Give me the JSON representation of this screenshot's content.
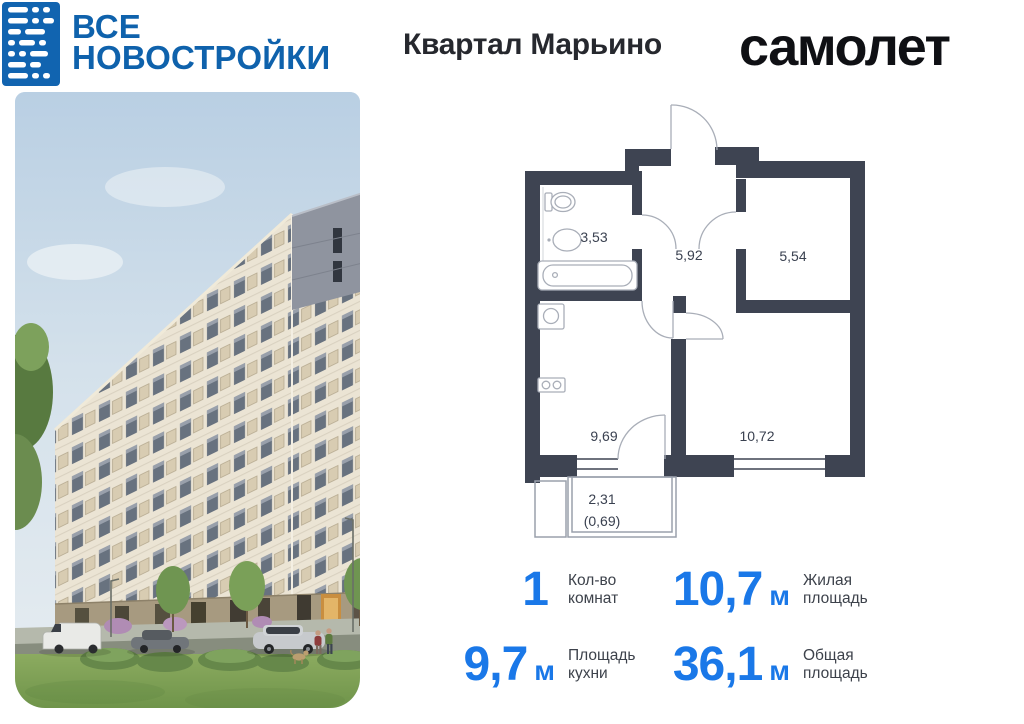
{
  "header": {
    "site_logo": {
      "line1": "ВСЕ",
      "line2": "НОВОСТРОЙКИ"
    },
    "title": "Квартал Марьино",
    "developer": "самолет"
  },
  "floor_plan": {
    "areas": {
      "bathroom": "3,53",
      "hallway": "5,92",
      "bedroom": "5,54",
      "kitchen": "9,69",
      "living_room": "10,72",
      "balcony": "2,31",
      "balcony_reduced": "(0,69)"
    }
  },
  "stats": [
    {
      "value": "1",
      "unit": "",
      "label1": "Кол-во",
      "label2": "комнат"
    },
    {
      "value": "10,7",
      "unit": "м",
      "label1": "Жилая",
      "label2": "площадь"
    },
    {
      "value": "9,7",
      "unit": "м",
      "label1": "Площадь",
      "label2": "кухни"
    },
    {
      "value": "36,1",
      "unit": "м",
      "label1": "Общая",
      "label2": "площадь"
    }
  ],
  "colors": {
    "brand_blue": "#1164b0",
    "accent_blue": "#1a78e8",
    "plan_wall": "#3e4452"
  }
}
